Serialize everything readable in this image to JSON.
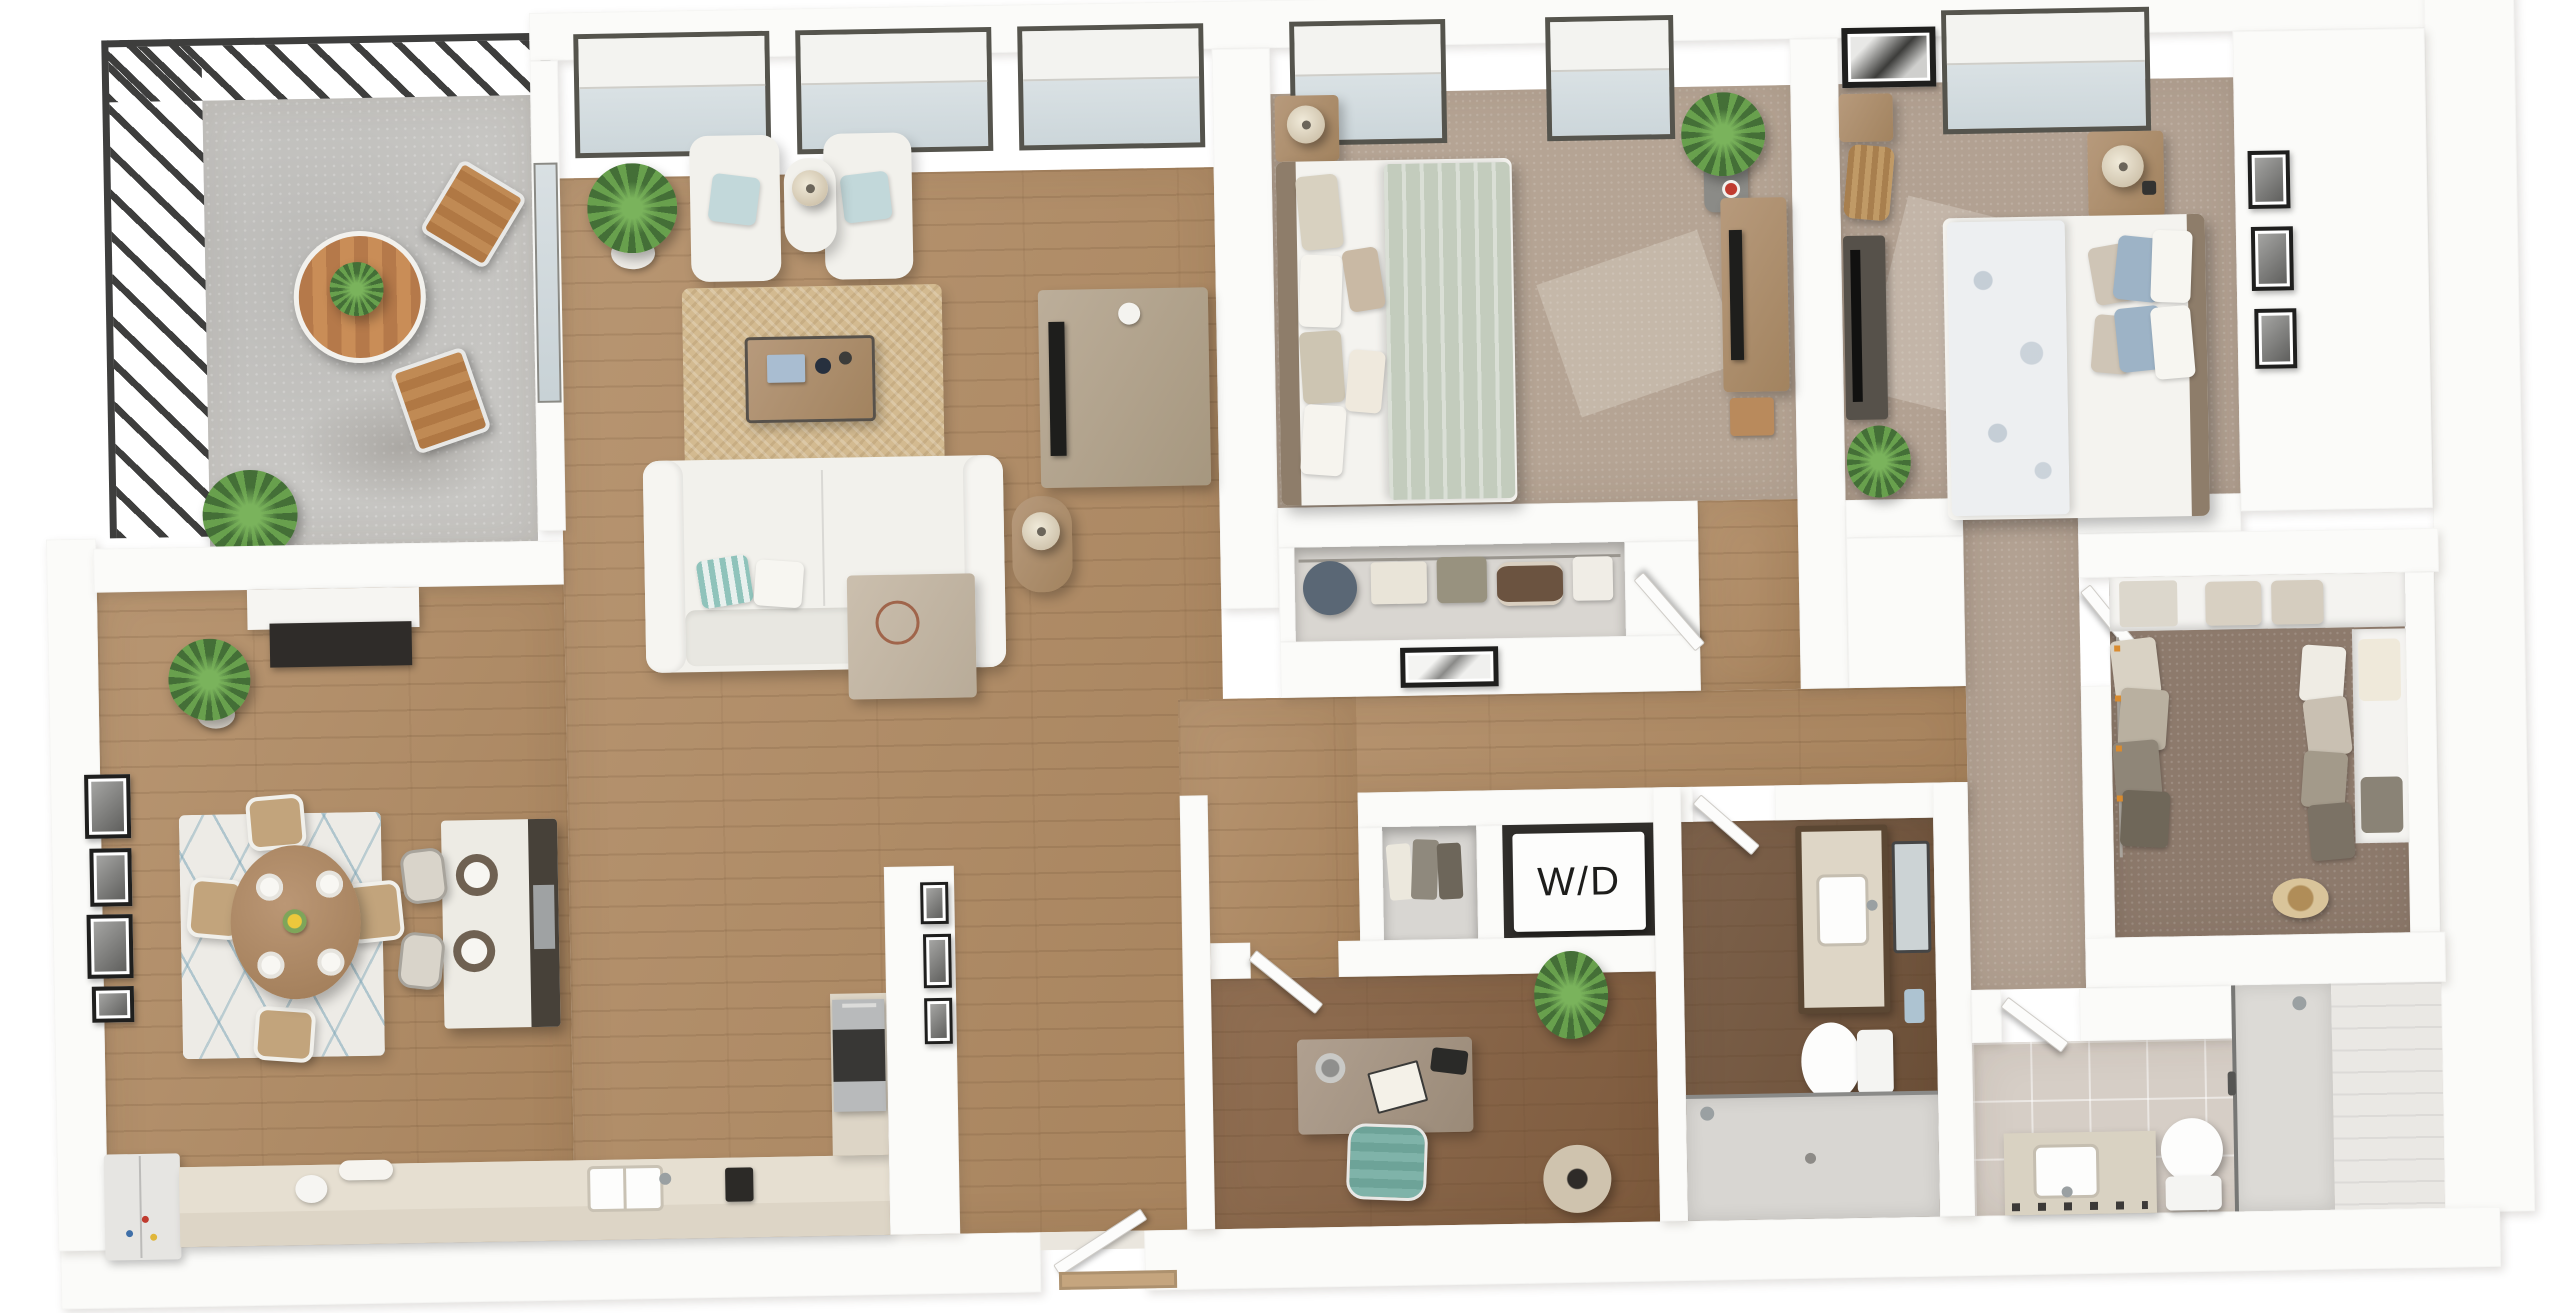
{
  "labels": {
    "washer_dryer": "W/D"
  },
  "palette": {
    "wall": "#fbfbf9",
    "wood_main": "#b08a62",
    "wood_dark": "#845f40",
    "wood_bath": "#6f5138",
    "carpet_bedroom1": "#b5a494",
    "carpet_bedroom2": "#b2a192",
    "carpet_closet": "#8d7a6c",
    "concrete": "#c7c6c3",
    "tile_bath": "#d6cec6",
    "rug_jute": "#d3ba90",
    "rug_dining": "#edebe6",
    "rug_dining_accent": "#7ca6b8",
    "railing": "#3e3e3d",
    "sofa_white": "#f2f1ec",
    "accent_teal": "#7fb3a9",
    "duvet_sage": "#c3ccbd",
    "duvet_floral": "#edeff1",
    "pillow_blue": "#9db3c6",
    "counter_beige": "#ddd5c6",
    "island_dark": "#474139",
    "stainless": "#b8babb",
    "label_text": "#1d1d1b"
  },
  "rooms": [
    {
      "id": "balcony"
    },
    {
      "id": "living-room"
    },
    {
      "id": "dining-area"
    },
    {
      "id": "kitchen"
    },
    {
      "id": "hallway"
    },
    {
      "id": "entry"
    },
    {
      "id": "bedroom-1"
    },
    {
      "id": "bedroom-1-closet"
    },
    {
      "id": "bedroom-2"
    },
    {
      "id": "walk-in-closet"
    },
    {
      "id": "bathroom-1"
    },
    {
      "id": "bathroom-2"
    },
    {
      "id": "laundry-closet"
    },
    {
      "id": "den-office"
    }
  ]
}
